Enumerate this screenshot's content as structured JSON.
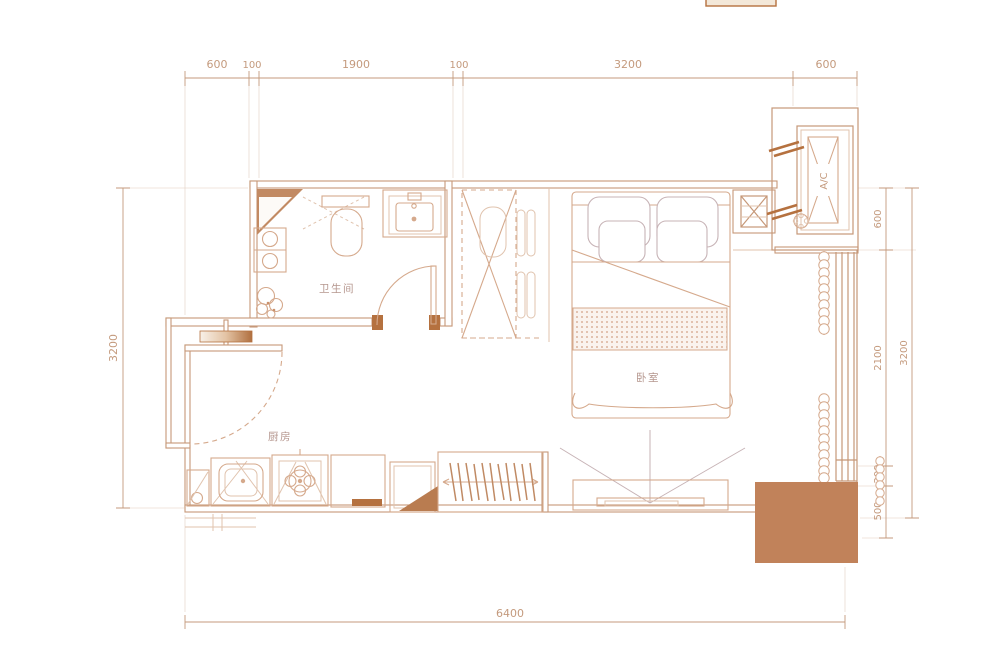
{
  "drawing": {
    "rooms": {
      "bathroom": "卫生间",
      "kitchen": "厨房",
      "bedroom": "卧室"
    },
    "ac_label": "A/C",
    "dims": {
      "top": [
        "600",
        "100",
        "1900",
        "100",
        "3200",
        "600"
      ],
      "bottom": "6400",
      "left": "3200",
      "right": [
        "600",
        "2100",
        "200",
        "500"
      ],
      "right_total": "3200"
    },
    "colors": {
      "wall": "#c69878",
      "furniture": "#d5a98c",
      "soft": "#e0c3ae",
      "gray": "#c7b3b6",
      "dim": "#c49a7d",
      "label": "#b5968e",
      "solid": "#c1825a",
      "accent": "#b5713f"
    }
  }
}
